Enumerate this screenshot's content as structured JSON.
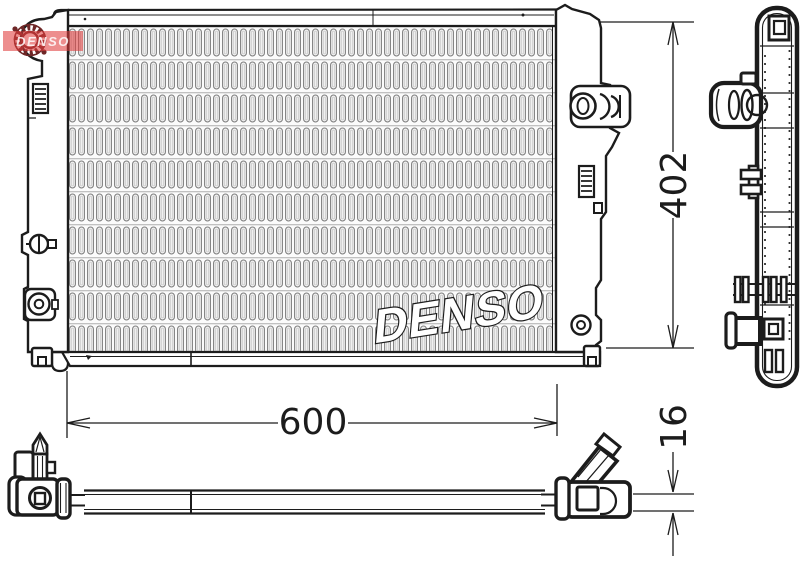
{
  "logo": {
    "text": "DENSO"
  },
  "watermark": {
    "text": "DENSO",
    "band_color": "#e03c3c",
    "text_color": "#ffffff"
  },
  "dimensions": {
    "height": {
      "value": "402"
    },
    "width": {
      "value": "600"
    },
    "thickness": {
      "value": "16"
    }
  },
  "colors": {
    "line": "#1c1c1c",
    "core_fin": "#808080",
    "watermark_red": "#e03c3c",
    "filler_neck_maroon": "#6e2727"
  }
}
